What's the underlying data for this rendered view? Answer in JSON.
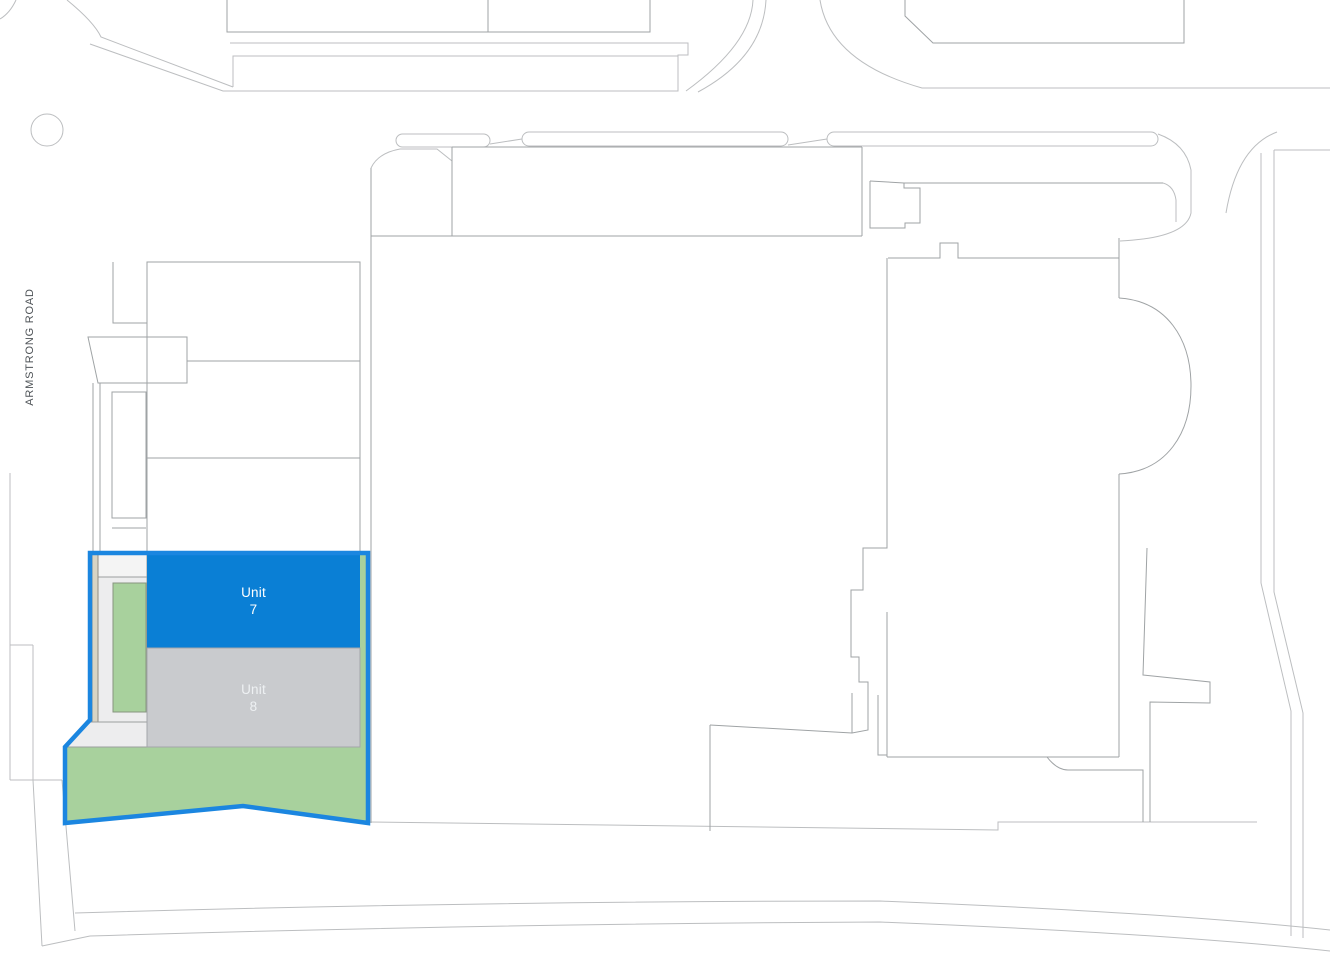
{
  "map": {
    "road_label": "ARMSTRONG ROAD",
    "units": [
      {
        "name": "Unit",
        "number": "7",
        "status": "highlighted"
      },
      {
        "name": "Unit",
        "number": "8",
        "status": "muted"
      }
    ],
    "colors": {
      "background": "#ffffff",
      "plan_line": "#bcbec0",
      "building_line": "#9fa3a5",
      "highlight_outline": "#1b86e0",
      "unit7_fill": "#0a7fd5",
      "unit7_text": "#ffffff",
      "unit8_fill": "#c9cbce",
      "unit8_text": "#eef1f3",
      "landscape_green": "#a8d19d",
      "hardstanding_gray": "#ededee",
      "kerb_tan": "#d8d4c4"
    }
  }
}
